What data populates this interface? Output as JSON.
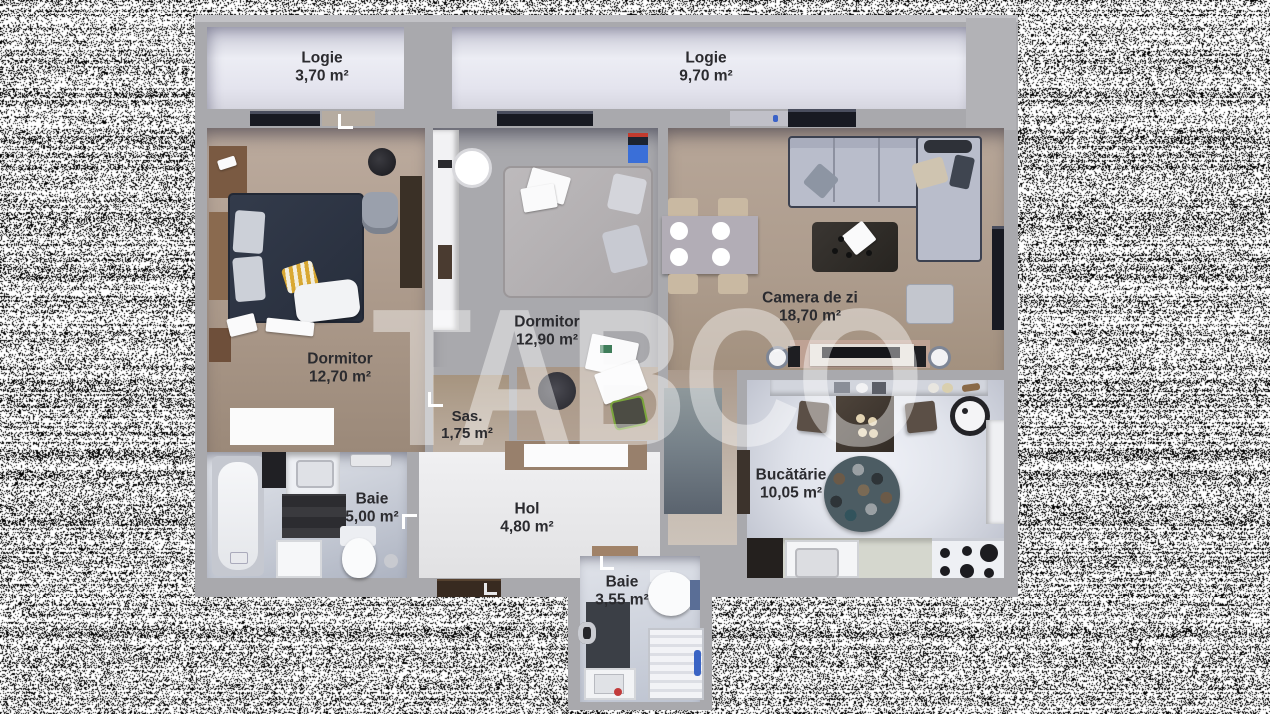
{
  "watermark": {
    "text": "TABCO"
  },
  "rooms": {
    "logie_left": {
      "name": "Logie",
      "area": "3,70 m²"
    },
    "logie_right": {
      "name": "Logie",
      "area": "9,70 m²"
    },
    "dormitor_left": {
      "name": "Dormitor",
      "area": "12,70 m²"
    },
    "dormitor_mid": {
      "name": "Dormitor",
      "area": "12,90 m²"
    },
    "camera_de_zi": {
      "name": "Camera de zi",
      "area": "18,70 m²"
    },
    "sas": {
      "name": "Sas.",
      "area": "1,75 m²"
    },
    "baie_mare": {
      "name": "Baie",
      "area": "5,00 m²"
    },
    "hol": {
      "name": "Hol",
      "area": "4,80 m²"
    },
    "bucatarie": {
      "name": "Bucătărie",
      "area": "10,05 m²"
    },
    "baie_mica": {
      "name": "Baie",
      "area": "3,55 m²"
    }
  },
  "palette": {
    "wall_gray": "#a9a9ad",
    "floor_taupe": "#ab998a",
    "loggia_floor": "#e7e7f0",
    "bath_floor": "#ccd1db",
    "label_text": "#2b2b2f",
    "watermark_white": "rgba(255,255,255,0.42)",
    "bed_navy": "#2c3442",
    "sofa_gray": "#b9bdcb"
  }
}
